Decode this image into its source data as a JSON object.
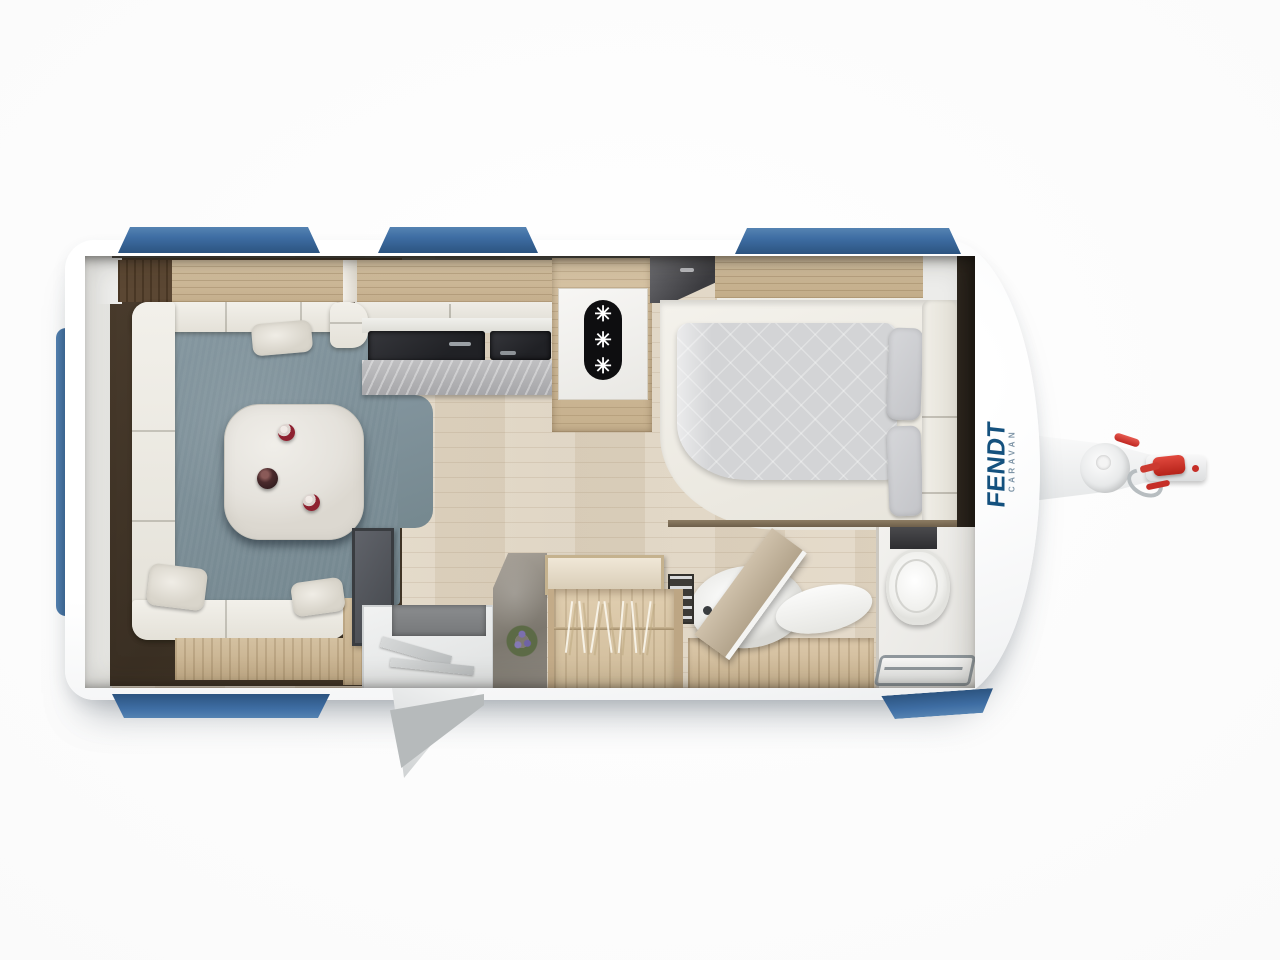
{
  "scene": {
    "title": "Caravan floor plan — top view",
    "rooms": [
      "lounge with U-shaped seating and table",
      "kitchen with sink and hob",
      "refrigerator",
      "french bed",
      "wardrobe with hangers",
      "washroom with toilet, basin and shower",
      "entrance with open door"
    ],
    "windows": {
      "top": 3,
      "bottom": 2,
      "front": 1
    }
  },
  "brand": {
    "name": "FENDT",
    "sub": "CARAVAN"
  },
  "fridge": {
    "symbols": [
      "✳",
      "✳",
      "✳"
    ]
  },
  "colors": {
    "window_blue": "#3e6da3",
    "window_blue_deep": "#2c5480",
    "carpet_blue_gray": "#7c8f99",
    "dark_wood": "#46382a",
    "wood_light": "#cfbb9c",
    "wood_floor": "#e3d9c8",
    "cushion_white": "#eeece5",
    "counter_marble": "#b5b5b7",
    "fridge_black": "#0e0e10",
    "duvet_gray": "#d3d4d6",
    "stone_gray": "#96918a",
    "brand_blue": "#14517e",
    "brand_sub_blue": "#7d94a6",
    "hitch_red": "#d03028",
    "chrome": "#9aa1a6",
    "body_white": "#ffffff"
  }
}
